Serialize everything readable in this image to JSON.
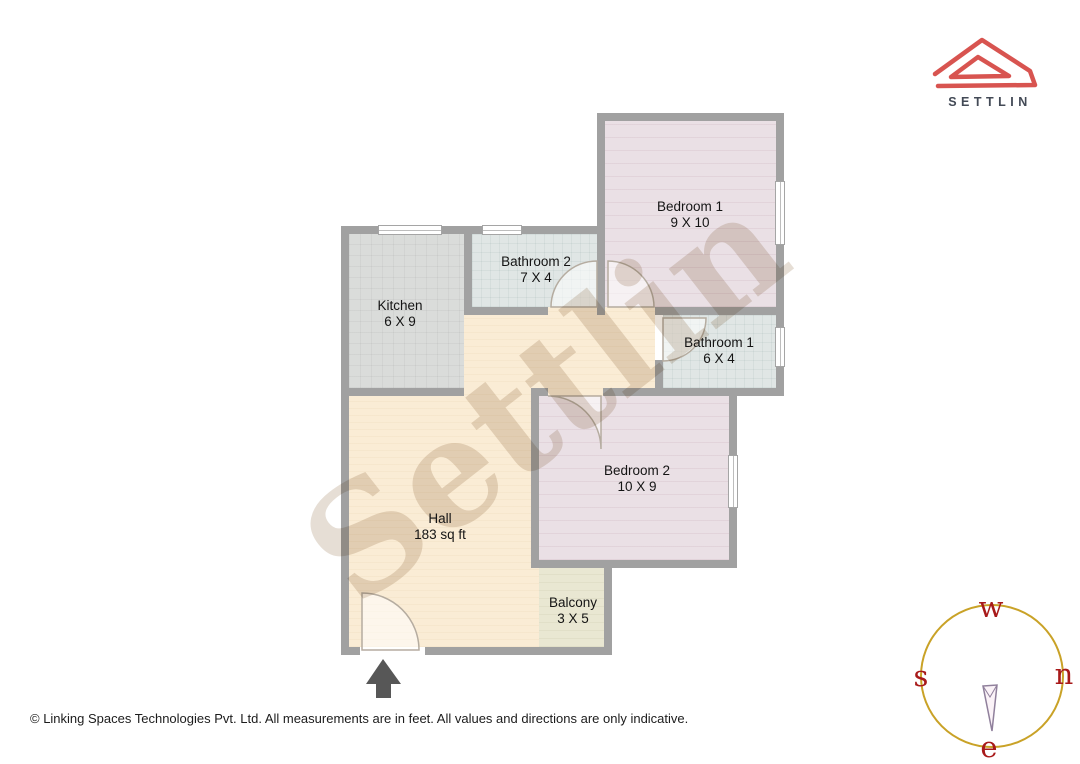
{
  "branding": {
    "logo_text": "SETTLIN",
    "logo_color": "#d85450",
    "logo_text_color": "#434a56"
  },
  "watermark": {
    "text": "Settlin"
  },
  "rooms": [
    {
      "id": "bedroom1",
      "name": "Bedroom 1",
      "dims": "9 X 10"
    },
    {
      "id": "bathroom2",
      "name": "Bathroom 2",
      "dims": "7 X 4"
    },
    {
      "id": "kitchen",
      "name": "Kitchen",
      "dims": "6 X 9"
    },
    {
      "id": "bathroom1",
      "name": "Bathroom 1",
      "dims": "6 X 4"
    },
    {
      "id": "bedroom2",
      "name": "Bedroom 2",
      "dims": "10 X 9"
    },
    {
      "id": "hall",
      "name": "Hall",
      "dims": "183 sq ft"
    },
    {
      "id": "balcony",
      "name": "Balcony",
      "dims": "3 X 5"
    }
  ],
  "compass": {
    "top": "w",
    "left": "s",
    "right": "n",
    "bottom": "e",
    "ring_color": "#c9a227",
    "letter_color": "#a81a1a"
  },
  "footer": {
    "text": "© Linking Spaces Technologies Pvt. Ltd. All measurements are in feet. All values and directions are only indicative."
  },
  "colors": {
    "wall": "#a1a1a1",
    "hall": "#faecd5",
    "bedroom": "#eae0e5",
    "bathroom": "#e0e6e5",
    "kitchen": "#dadcda",
    "balcony": "#e9e7d2"
  }
}
